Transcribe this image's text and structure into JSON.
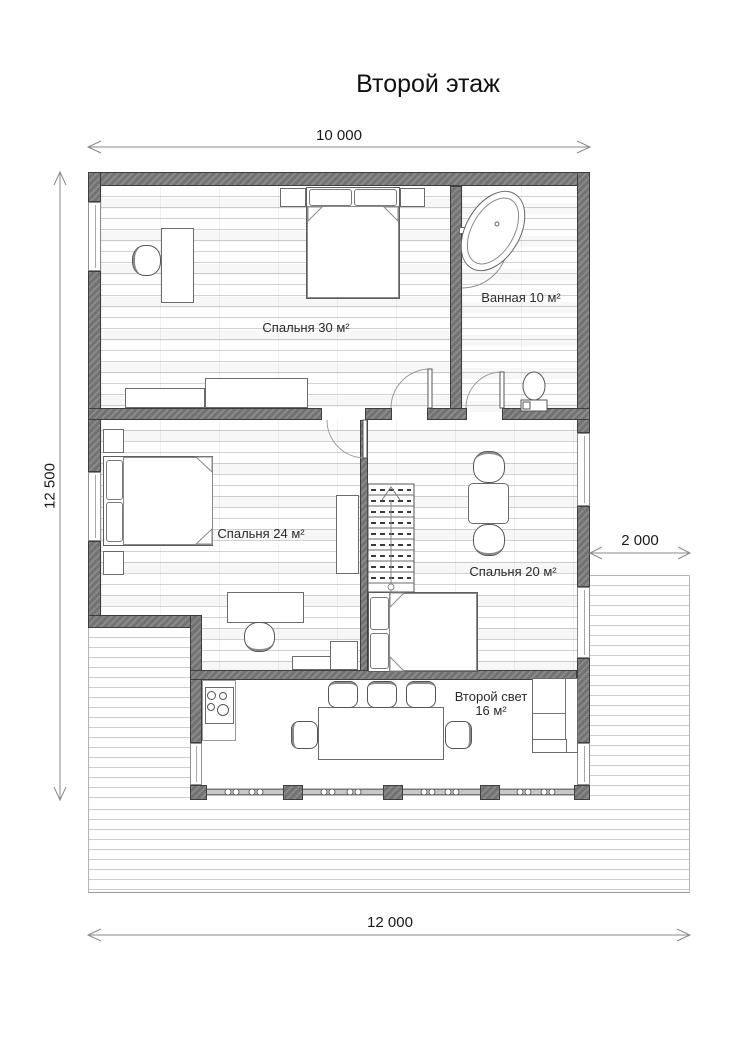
{
  "title": "Второй этаж",
  "dimensions": {
    "top": "10 000",
    "left": "12 500",
    "right": "2 000",
    "bottom": "12 000"
  },
  "rooms": {
    "bedroom30": {
      "label": "Спальня 30 м²"
    },
    "bathroom": {
      "label": "Ванная 10 м²"
    },
    "bedroom24": {
      "label": "Спальня 24 м²"
    },
    "bedroom20": {
      "label": "Спальня 20 м²"
    },
    "second_light": {
      "label": "Второй свет",
      "area": "16 м²"
    }
  },
  "colors": {
    "wall_fill": "#737373",
    "wall_outline": "#3e3e3e",
    "floor_line": "#d2d2d2",
    "dimension_line": "#8a8a8a",
    "text": "#1a1a1a"
  }
}
